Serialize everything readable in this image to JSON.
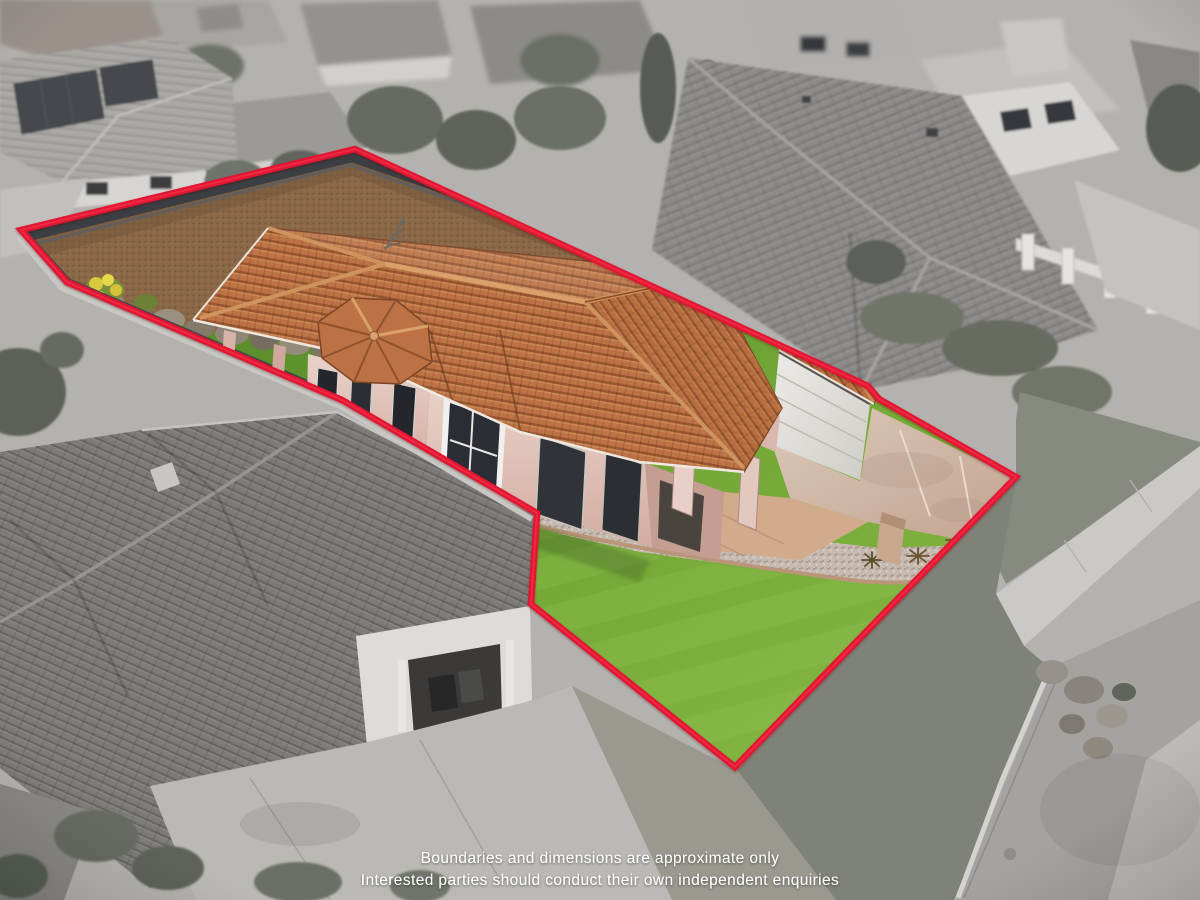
{
  "photo": {
    "kind": "aerial-real-estate-photo",
    "subject": "single-storey terracotta-roof house on corner-style lot, subject lot in colour, surroundings desaturated"
  },
  "boundary": {
    "points": "21,230 355,149 868,386 879,399 1016,477 735,767 531,604 537,513 342,400 67,282",
    "color": "#e31233"
  },
  "disclaimer": {
    "line1": "Boundaries and dimensions are approximate only",
    "line2": "Interested parties should conduct their own independent enquiries",
    "text_color": "#ffffff"
  },
  "palette": {
    "lawn_green_light": "#83b542",
    "lawn_green_dark": "#4f7f27",
    "roof_terracotta": "#bd7345",
    "wall_render_pink": "#e2c5bb",
    "driveway_concrete": "#d2bca9",
    "fence_charcoal": "#3b3e43",
    "mulch_brown": "#8a6847",
    "gravel_beige": "#c6bab0",
    "surroundings_gray": "#b4b2af",
    "street_asphalt": "#a5a3a0"
  }
}
